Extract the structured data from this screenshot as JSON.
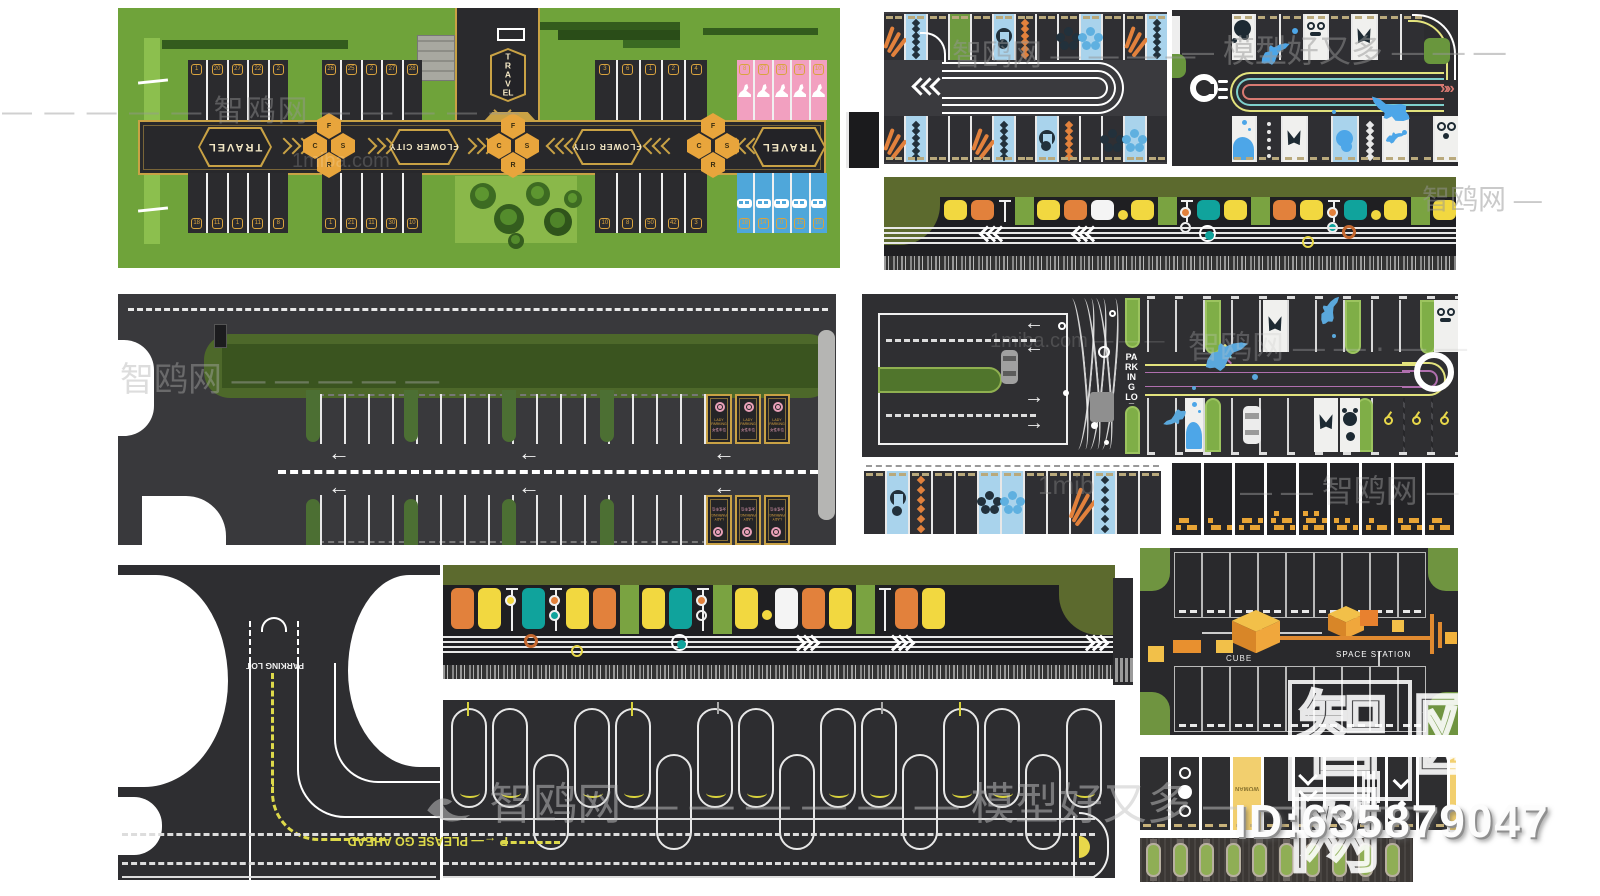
{
  "colors": {
    "asphalt": "#323236",
    "asphalt_dark": "#2a2a2e",
    "panel_green": "#6fa33a",
    "hedge_dark": "#335c1d",
    "gold": "#c9a245",
    "pink_stall": "#f2a0c0",
    "blue_stall": "#4fa7da",
    "stall_dark": "#2b2b2e",
    "teal": "#10a39c",
    "orange": "#e2813c",
    "yellow": "#f2d840",
    "grass": "#6d9a3f",
    "olive_band": "#5c6a2e",
    "lane_yellow": "#e3e37d",
    "lane_red": "#d97a72",
    "lane_teal": "#7fd0cc",
    "lane_purple": "#b06fae",
    "blue_light": "#a9d3ec",
    "navy": "#22313c",
    "paver": "#3b3734",
    "hedge_island": "#8fae55",
    "guide_yellow": "#ddd94a"
  },
  "flower_lot": {
    "sign_travel": "TRAVEL",
    "band_labels": {
      "travel_left": "TRAVEL",
      "flower_city_left": "FLOWER CITY",
      "flower_city_right": "FLOWER CITY",
      "travel_right": "TRAVEL"
    },
    "cluster_letters": [
      "F",
      "C",
      "S",
      "R"
    ],
    "stall_groups_top": [
      {
        "style": "dark",
        "numbers": [
          "1",
          "20",
          "27",
          "22",
          "2"
        ]
      },
      {
        "style": "dark",
        "numbers": [
          "26",
          "25",
          "2",
          "27",
          "28"
        ]
      },
      {
        "style": "dark",
        "numbers": [
          "3",
          "6",
          "1",
          "2",
          "4"
        ]
      },
      {
        "style": "pink",
        "numbers": [
          "8",
          "37",
          "33",
          "9",
          "10"
        ]
      }
    ],
    "stall_groups_bottom": [
      {
        "style": "dark",
        "numbers": [
          "18",
          "11",
          "1",
          "11",
          "8"
        ]
      },
      {
        "style": "dark",
        "numbers": [
          "1",
          "21",
          "11",
          "30",
          "10"
        ]
      },
      {
        "style": "dark",
        "numbers": [
          "10",
          "8",
          "50",
          "42",
          "3"
        ]
      },
      {
        "style": "blue",
        "numbers": [
          "18",
          "14",
          "0",
          "15",
          "10"
        ]
      }
    ]
  },
  "wave_lot": {
    "top_stalls": [
      "dark:palm",
      "blue:chainD",
      "dark",
      "grass",
      "dark",
      "blue:leaf",
      "dark:chainO",
      "dark",
      "dark:flowerD",
      "blue:flowerB",
      "dark",
      "dark:palm",
      "blue:chainD"
    ],
    "bottom_stalls": [
      "dark:palm",
      "blue:chainD",
      "dark",
      "dark",
      "dark:palm",
      "blue:chainD",
      "dark",
      "blue:leaf",
      "dark:chainO",
      "dark",
      "dark:flowerD",
      "blue:flowerB",
      "dark"
    ]
  },
  "ocean_lot": {
    "top_stalls": [
      "white:whale",
      "dark",
      "dark",
      "white:squid",
      "dark",
      "white:tail",
      "dark",
      "dark"
    ],
    "bottom_stalls": [
      "white:splash",
      "dark:dots",
      "white:tail",
      "dark",
      "blue:monst",
      "dark:chainD",
      "white:dolph",
      "dark",
      "white:ram"
    ],
    "arrow": "»"
  },
  "strip_top": {
    "chevron": "«",
    "items": [
      "yellow",
      "orange",
      "pole:",
      "grass",
      "yellow",
      "orange",
      "white",
      "dotY",
      "yellow",
      "grass",
      "pole:orange,white",
      "teal",
      "yellow",
      "grass",
      "orange",
      "yellow",
      "pole:orange,teal",
      "teal",
      "dotY",
      "yellow",
      "grass",
      "yellow",
      "orange"
    ],
    "chevron_positions": [
      17,
      33
    ],
    "circles": [
      {
        "pos": 55,
        "kind": "teal"
      },
      {
        "pos": 73,
        "kind": "yellow",
        "low": true
      },
      {
        "pos": 80,
        "kind": "orange"
      }
    ]
  },
  "strip_bottom": {
    "chevron": "»",
    "items": [
      "orange",
      "yellow",
      "pole:yellow",
      "teal",
      "pole:orange,teal",
      "yellow",
      "orange",
      "grass",
      "yellow",
      "teal",
      "pole:orange,white",
      "grass",
      "yellow",
      "dotY",
      "white",
      "orange",
      "yellow",
      "grass",
      "pole:",
      "orange",
      "yellow"
    ],
    "chevron_positions": [
      52,
      66,
      95
    ],
    "circles": [
      {
        "pos": 12,
        "kind": "orange"
      },
      {
        "pos": 19,
        "kind": "yellow",
        "low": true
      },
      {
        "pos": 34,
        "kind": "teal"
      }
    ]
  },
  "big_lot": {
    "lady_label": "LADY PARKING",
    "lady_sub": "女性车位"
  },
  "road_lot": {
    "label": "PARKING LOT"
  },
  "junction": {
    "entry_label": "PARKING LOT",
    "road_label": "P ←— PLEASE GO AHEAD"
  },
  "space_lot": {
    "cube_label": "CUBE",
    "station_label": "SPACE STATION"
  },
  "woman_strip": {
    "woman_label": "WOMAN",
    "stalls": [
      "plain",
      "circles",
      "plain",
      "woman",
      "plain",
      "chevron2",
      "plain",
      "bars",
      "chevron1",
      "plain",
      "yellowEnd"
    ]
  },
  "pixel_strip": {
    "clusters": [
      5,
      4,
      6,
      7,
      8,
      5,
      4,
      6,
      5
    ]
  },
  "hedge_strip": {
    "island_count": 10
  },
  "u_lot": {
    "columns": 16,
    "drop_pattern": [
      0,
      0,
      1,
      0,
      0,
      1,
      0,
      0,
      1,
      0,
      0,
      1,
      0,
      0,
      1,
      0
    ]
  },
  "watermarks": {
    "top_left": "— — — — — 智鸥网 — — — — —",
    "panel_a_center": "1miba.com",
    "top_mid": "智鸥网 — — — —",
    "top_right": "— 模型好又多 — — —",
    "right_strip": "智鸥网 —",
    "mid_left": "智鸥网 — — — — —",
    "mid_center": "1miba.com — — —",
    "mid_right": "智鸥网 — — · — —",
    "low_left": "1mib",
    "low_right": "— — 智鸥网 —",
    "bottom_center": "智鸥网 — — — — — — 模型好又多 — — — —"
  },
  "footer": {
    "brand_char_1": "智",
    "brand_char_2": "鸥",
    "brand_char_3": "网",
    "id_text": "ID:635879047"
  }
}
